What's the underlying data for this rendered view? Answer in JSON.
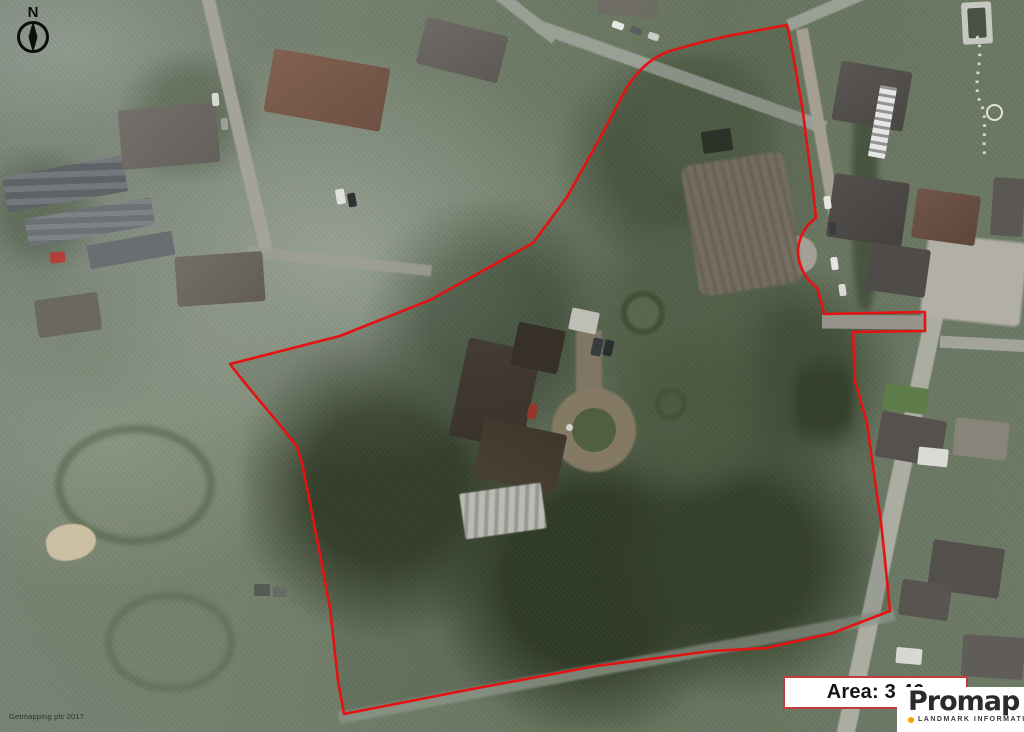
{
  "compass": {
    "north_label": "N"
  },
  "attribution": {
    "text": "Getmapping plc 2017."
  },
  "area_box": {
    "label": "Area: 3.46",
    "border_color": "#c13c3c",
    "text_color": "#141414"
  },
  "branding": {
    "wordmark": "Promap",
    "tagline": "LANDMARK INFORMATION",
    "dot_color": "#f0a400"
  },
  "boundary": {
    "color": "#e51212"
  }
}
